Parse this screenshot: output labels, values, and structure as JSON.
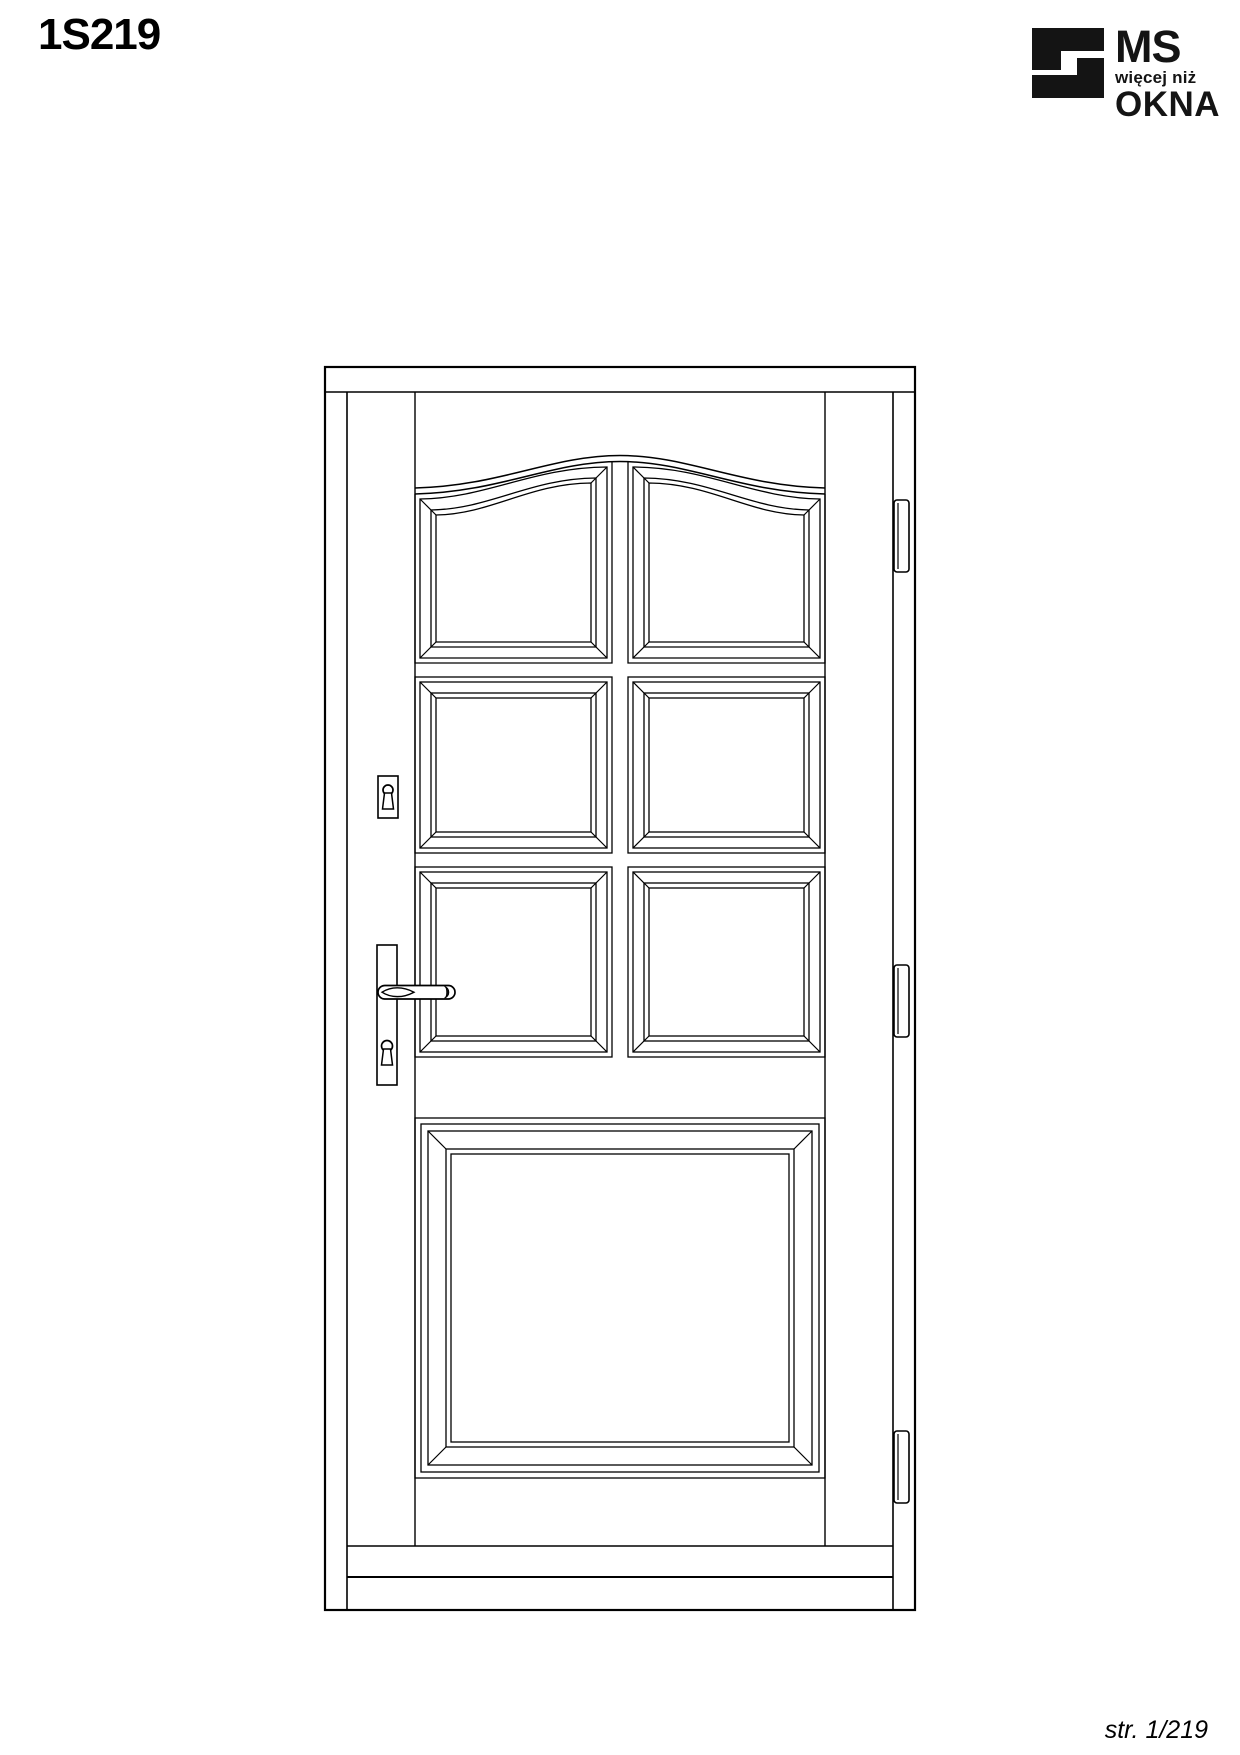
{
  "page": {
    "title": "1S219",
    "footer": "str. 1/219",
    "background": "#ffffff",
    "line_color": "#000000"
  },
  "logo": {
    "ms": "MS",
    "tagline": "więcej niż",
    "okna": "OKNA",
    "color": "#141414"
  },
  "door": {
    "small_panel_rows": 3,
    "panel_columns": 2,
    "large_bottom_panels": 1,
    "arched_top": true,
    "hinge_count": 3,
    "hinge_side": "right",
    "handle_side": "left",
    "keyhole_escutcheons": 2
  }
}
